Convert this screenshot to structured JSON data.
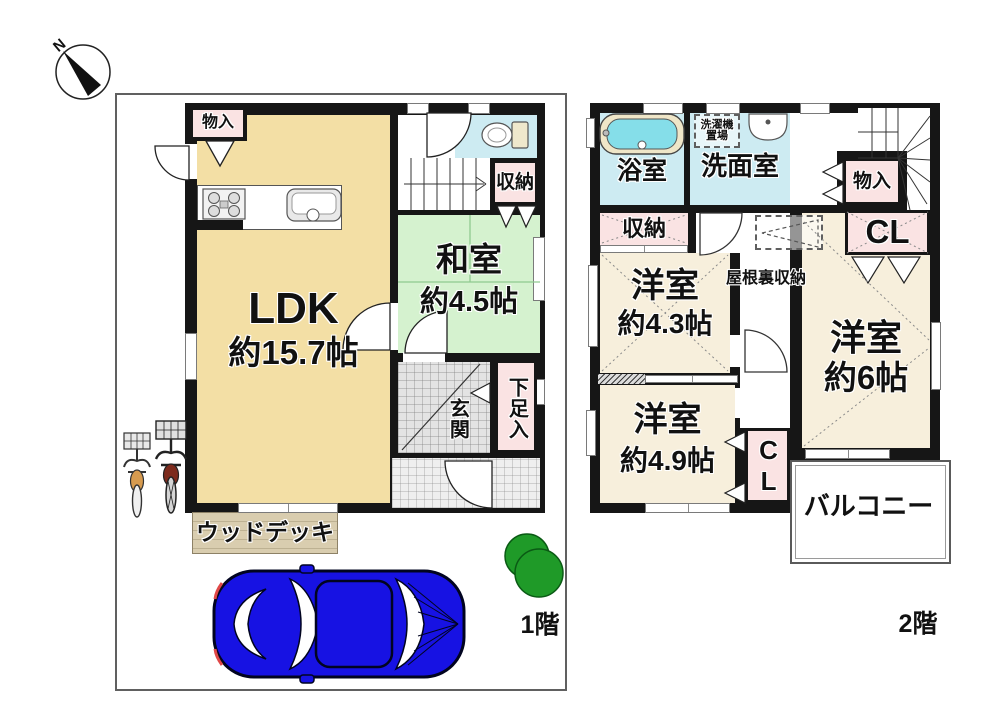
{
  "compass": {
    "north": "N"
  },
  "f1": {
    "floor_label": "1階",
    "ldk_name": "LDK",
    "ldk_size": "約15.7帖",
    "washitsu_name": "和室",
    "washitsu_size": "約4.5帖",
    "monoire": "物入",
    "shunou": "収納",
    "genkan": "玄関",
    "shoe_box": "下足入",
    "wood_deck": "ウッドデッキ"
  },
  "f2": {
    "floor_label": "2階",
    "bath": "浴室",
    "senmen": "洗面室",
    "laundry_line1": "洗濯機",
    "laundry_line2": "置場",
    "monoire": "物入",
    "cl_upper": "CL",
    "shunou": "収納",
    "attic": "屋根裏収納",
    "west43_name": "洋室",
    "west43_size": "約4.3帖",
    "west6_name": "洋室",
    "west6_size": "約6帖",
    "west49_name": "洋室",
    "west49_size": "約4.9帖",
    "cl_lower": "CL",
    "balcony": "バルコニー"
  },
  "colors": {
    "wall": "#161616",
    "ldk_cream": "#f3dfa5",
    "room_cream_2f": "#f7efdc",
    "tatami_green": "#d5f2cf",
    "wet_cyan": "#cdebf2",
    "closet_pink": "#fae3e3",
    "car_blue": "#1712e3",
    "tree_green": "#1f9a28"
  }
}
